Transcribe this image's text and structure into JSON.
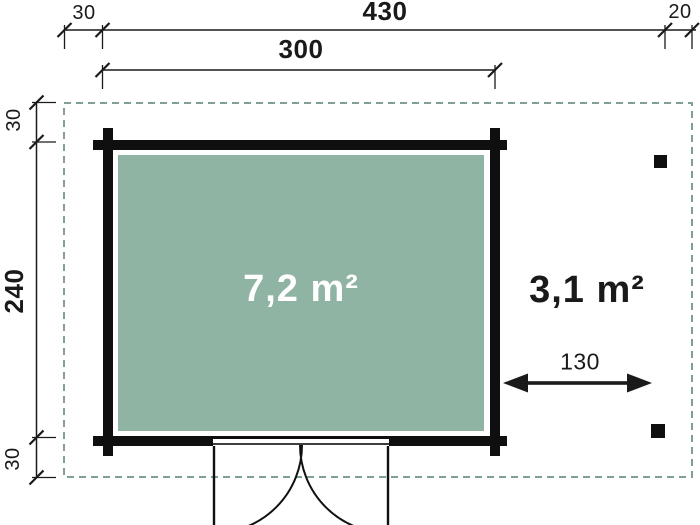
{
  "plan": {
    "dim_top_left_offset": "30",
    "dim_top_total": "430",
    "dim_top_right_offset": "20",
    "dim_top_inner_width": "300",
    "dim_left_top_offset": "30",
    "dim_left_height": "240",
    "dim_left_bottom_offset": "30",
    "dim_canopy_width": "130",
    "area_interior": "7,2 m²",
    "area_canopy": "3,1 m²"
  },
  "colors": {
    "interior_fill": "#8FB4A3",
    "boundary_dash": "#7EA193",
    "wall": "#0F0F0F",
    "dim_line": "#1A1A1A",
    "area_interior_text": "#FFFFFF",
    "area_canopy_text": "#1A1A1A"
  }
}
